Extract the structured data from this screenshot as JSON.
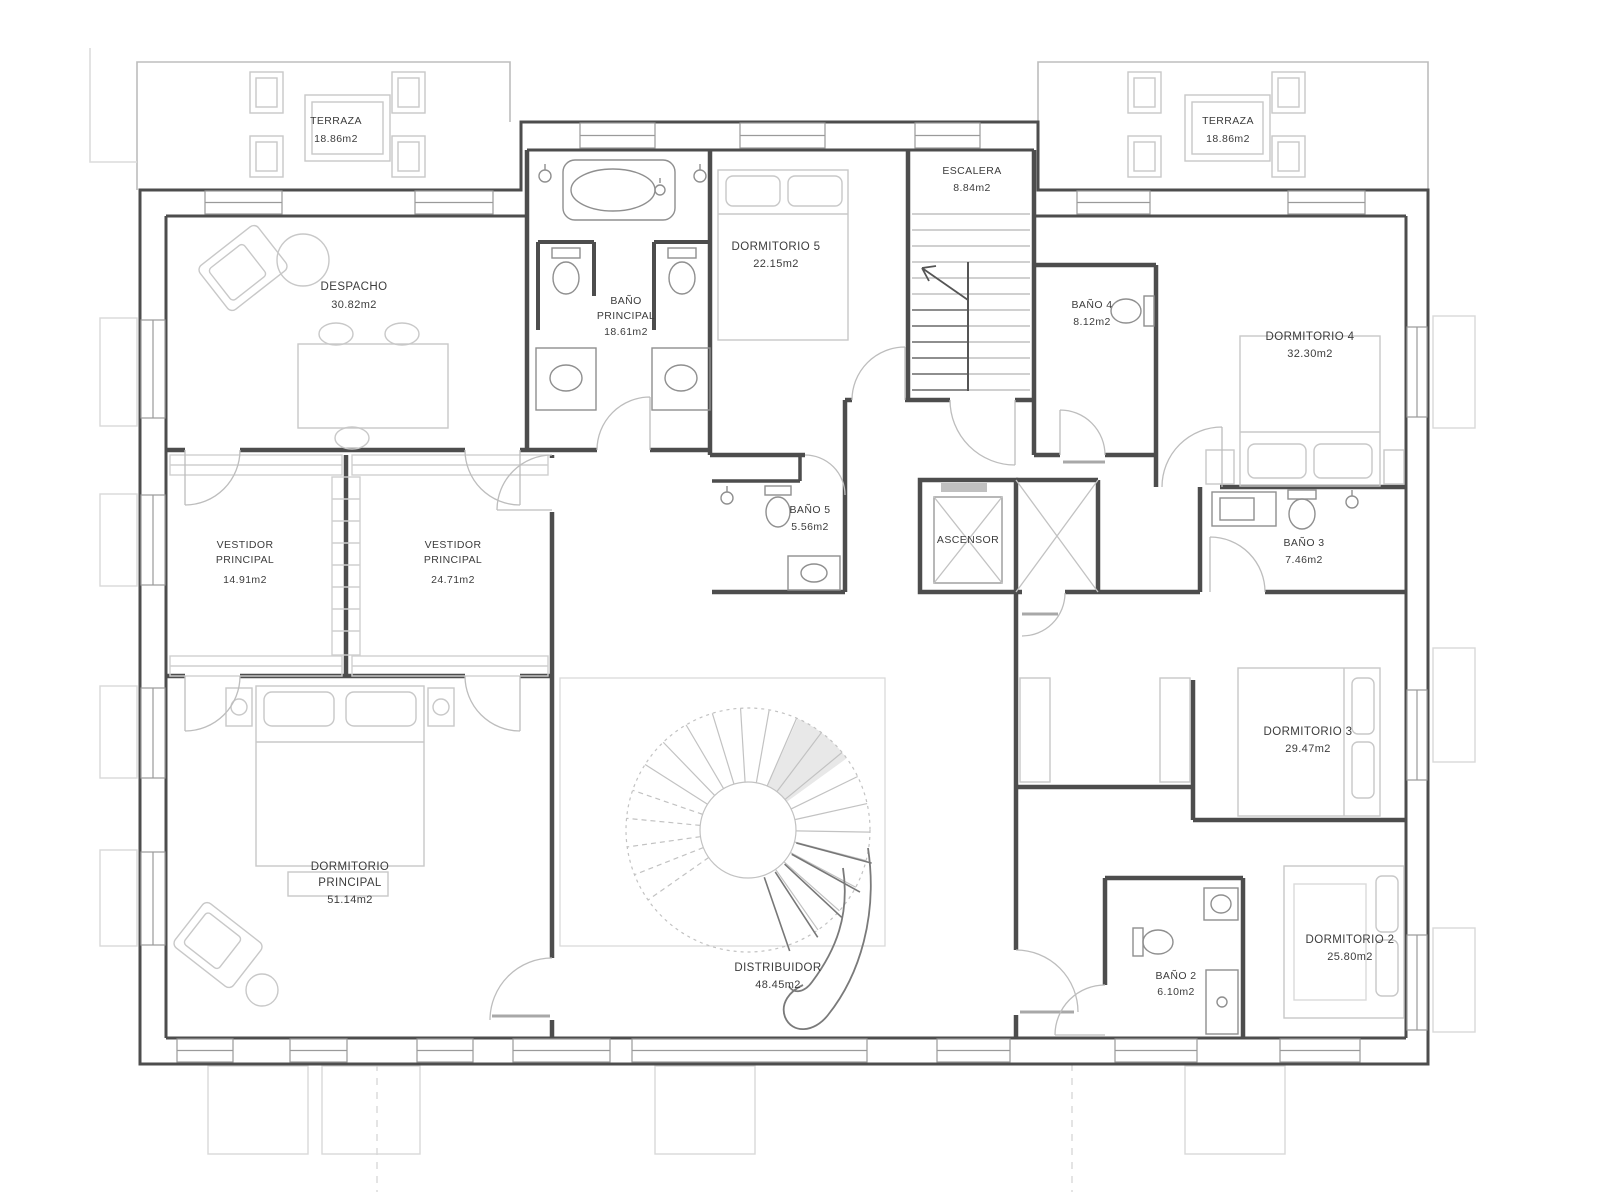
{
  "colors": {
    "wall": "#4d4d4d",
    "fixture": "#8f8f8f",
    "ghost": "#c8c8c8",
    "terrace": "#bdbdbd",
    "glass": "#9a9a9a",
    "label": "#3c3c3c",
    "shade": "#e8e8e8"
  },
  "rooms": {
    "terraza_izq": {
      "name": "TERRAZA",
      "area": "18.86m2"
    },
    "terraza_der": {
      "name": "TERRAZA",
      "area": "18.86m2"
    },
    "despacho": {
      "name": "DESPACHO",
      "area": "30.82m2"
    },
    "bano_principal": {
      "name1": "BAÑO",
      "name2": "PRINCIPAL",
      "area": "18.61m2"
    },
    "dormitorio5": {
      "name": "DORMITORIO 5",
      "area": "22.15m2"
    },
    "escalera": {
      "name": "ESCALERA",
      "area": "8.84m2"
    },
    "bano4": {
      "name": "BAÑO 4",
      "area": "8.12m2"
    },
    "dormitorio4": {
      "name": "DORMITORIO 4",
      "area": "32.30m2"
    },
    "vestidor_izq": {
      "name1": "VESTIDOR",
      "name2": "PRINCIPAL",
      "area": "14.91m2"
    },
    "vestidor_der": {
      "name1": "VESTIDOR",
      "name2": "PRINCIPAL",
      "area": "24.71m2"
    },
    "bano5": {
      "name": "BAÑO 5",
      "area": "5.56m2"
    },
    "ascensor": {
      "name": "ASCENSOR"
    },
    "bano3": {
      "name": "BAÑO 3",
      "area": "7.46m2"
    },
    "dormitorio3": {
      "name": "DORMITORIO 3",
      "area": "29.47m2"
    },
    "dormitorio_principal": {
      "name1": "DORMITORIO",
      "name2": "PRINCIPAL",
      "area": "51.14m2"
    },
    "distribuidor": {
      "name": "DISTRIBUIDOR",
      "area": "48.45m2"
    },
    "bano2": {
      "name": "BAÑO 2",
      "area": "6.10m2"
    },
    "dormitorio2": {
      "name": "DORMITORIO 2",
      "area": "25.80m2"
    }
  }
}
